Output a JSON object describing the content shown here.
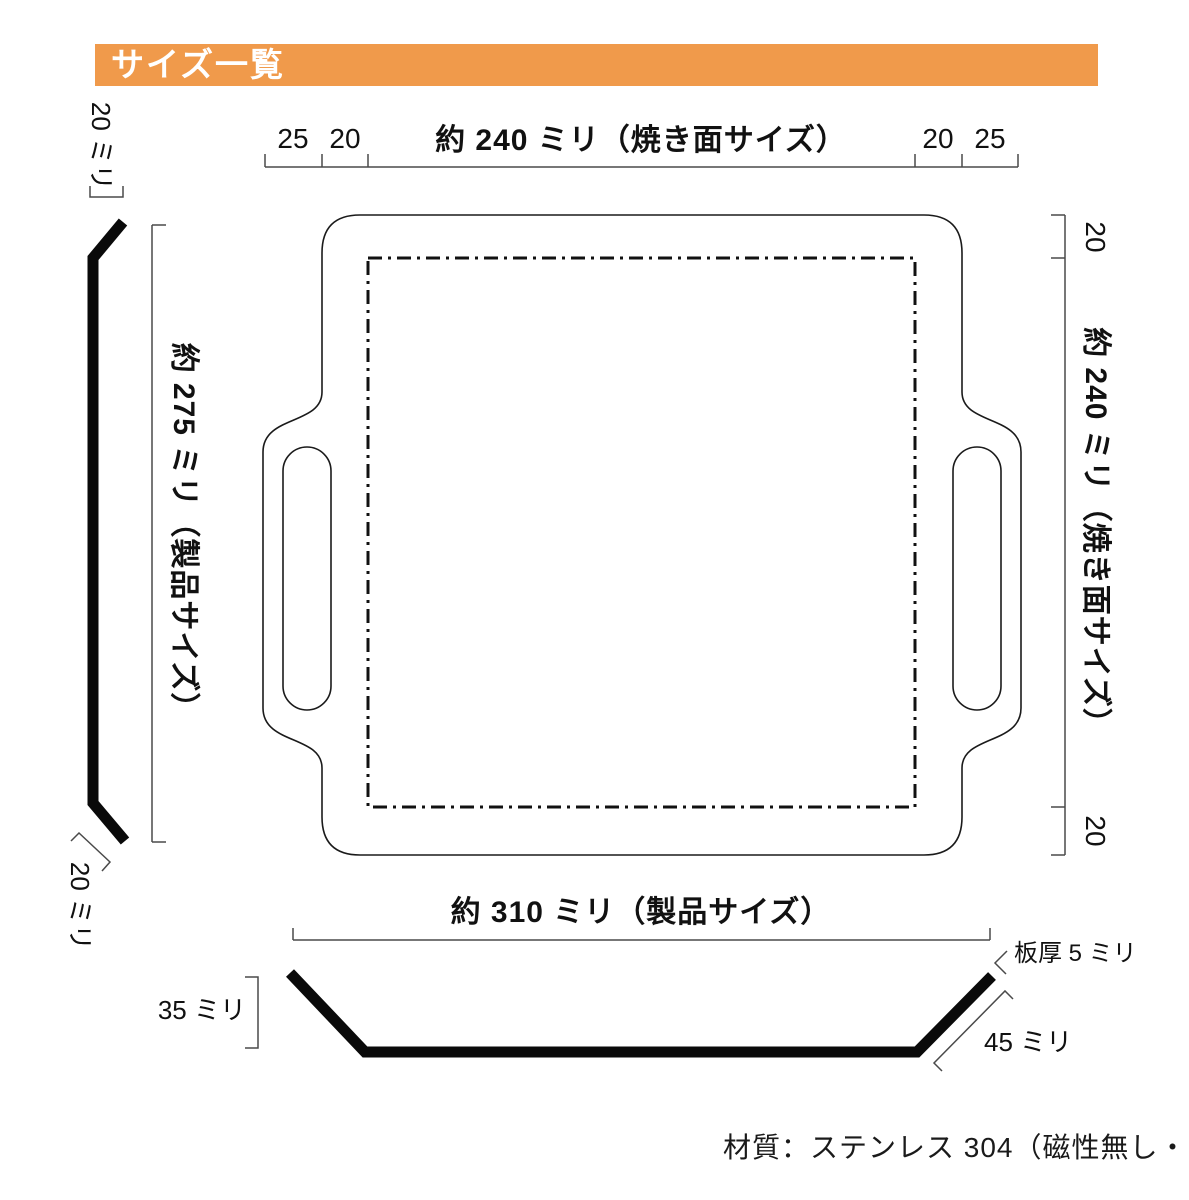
{
  "header": {
    "title": "サイズ一覧"
  },
  "top_dimension": {
    "left_outer": "25",
    "left_inner": "20",
    "label": "約 240 ミリ（焼き面サイズ）",
    "right_inner": "20",
    "right_outer": "25"
  },
  "right_dimension": {
    "top": "20",
    "label": "約 240 ミリ（焼き面サイズ）",
    "bottom": "20"
  },
  "left_dimension": {
    "label": "約 275 ミリ（製品サイズ）"
  },
  "left_side_view": {
    "top_edge_height": "20 ミリ",
    "bottom_edge_height": "20 ミリ"
  },
  "bottom_dimension": {
    "label": "約 310 ミリ（製品サイズ）"
  },
  "bottom_side_view": {
    "depth": "35 ミリ",
    "plate_thickness": "板厚 5 ミリ",
    "edge_length": "45 ミリ"
  },
  "footer": {
    "material": "材質：ステンレス 304（磁性無し・国産）"
  },
  "colors": {
    "accent": "#F09A4B",
    "line": "#1A1A1A",
    "dim_line": "#4A4A4A"
  }
}
